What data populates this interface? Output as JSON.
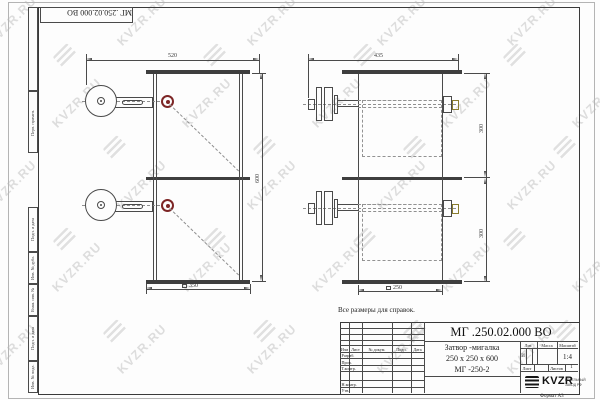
{
  "watermark": {
    "text": "KVZR.RU"
  },
  "stamp": {
    "designation": "МГ .250.02.000 ВО"
  },
  "margin": {
    "perv": "Перв. примен.",
    "podp1": "Подп. и дата",
    "inv_dubl": "Инв. № дубл.",
    "vzam": "Взам. инв. №",
    "podp2": "Подп. и дата",
    "inv_podl": "Инв. № подл."
  },
  "note": "Все размеры для справок.",
  "front_view": {
    "dim_width": "520",
    "dim_height": "600",
    "dim_bottom": "350"
  },
  "side_view": {
    "dim_width": "435",
    "dim_h1": "300",
    "dim_h2": "300",
    "dim_bottom": "250"
  },
  "title_block": {
    "designation": "МГ .250.02.000 ВО",
    "name1": "Затвор -мигалка",
    "name2": "250 х 250 х 600",
    "name3": "МГ -250-2",
    "h_izm": "Изм",
    "h_list": "Лист",
    "h_dokum": "№ докум.",
    "h_podp": "Подп.",
    "h_data": "Дата",
    "r_razrab": "Разраб.",
    "r_prov": "Пров.",
    "r_tkontr": "Т.контр.",
    "r_nkontr": "Н.контр.",
    "r_utv": "Утв.",
    "h_lit": "Лит.",
    "h_massa": "Масса",
    "h_masshtab": "Масштаб",
    "v_lit": "И",
    "v_masshtab": "1:4",
    "h_list2": "Лист",
    "h_listov": "Листов",
    "v_listov": "1",
    "logo": "KVZR",
    "logo_sub1": "КОТЕЛЬНЫЙ",
    "logo_sub2": "ЗАВОД РФ",
    "format": "Формат А3"
  }
}
